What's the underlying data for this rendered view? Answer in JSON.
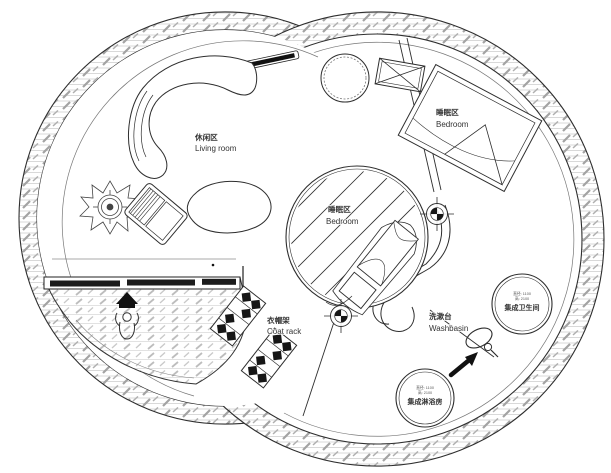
{
  "plan": {
    "labels": {
      "living_room": {
        "zh": "休闲区",
        "en": "Living room"
      },
      "bedroom_upper": {
        "zh": "睡眠区",
        "en": "Bedroom"
      },
      "bedroom_center": {
        "zh": "睡眠区",
        "en": "Bedroom"
      },
      "coat_rack": {
        "zh": "衣帽架",
        "en": "Coat rack"
      },
      "washbasin": {
        "zh": "洗漱台",
        "en": "Washbasin"
      }
    },
    "pods": {
      "toilet": {
        "dim_line1": "直径: 1100",
        "dim_line2": "高: 2100",
        "name": "集成卫生间"
      },
      "shower": {
        "dim_line1": "直径: 1100",
        "dim_line2": "高: 2100",
        "name": "集成淋浴房"
      }
    },
    "colors": {
      "line": "#2e2e2e",
      "hatch_gray": "#a3a3a3",
      "dark_fill": "#161616",
      "paper": "#ffffff",
      "text": "#333333"
    },
    "icons": [
      "plant-icon",
      "armchair-icon",
      "sofa-icon",
      "coffee-table-icon",
      "round-table-icon",
      "equipment-box-icon",
      "bed-icon",
      "column-marker-icon",
      "coat-rack-icon",
      "washbasin-counter-icon",
      "mirror-icon",
      "direction-arrow-icon",
      "person-icon",
      "entrance-arrow-icon",
      "sliding-door-icon"
    ]
  }
}
